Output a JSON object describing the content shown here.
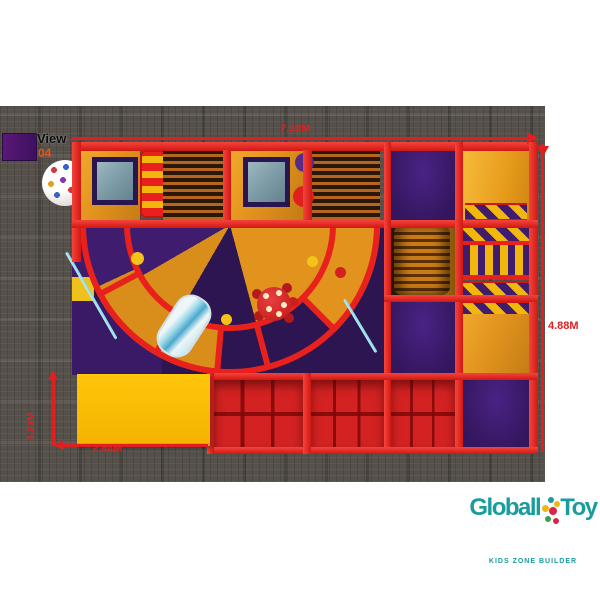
{
  "view": {
    "title": "View",
    "number": "04"
  },
  "dimensions": {
    "overall_width": "7.32M",
    "overall_depth": "4.88M",
    "mat_length": "2.44M",
    "mat_width": "1.22M"
  },
  "logo": {
    "brand_left": "Globall",
    "brand_right": "Toy",
    "tagline": "KIDS ZONE BUILDER"
  },
  "colors": {
    "frame_red": "#e8211d",
    "panel_orange": "#e2931e",
    "panel_purple": "#3f1c6e",
    "panel_navy": "#2c1550",
    "mat_yellow": "#ffc60a",
    "hazard_yellow": "#f2b70d",
    "pit_red": "#d42222",
    "carpet_gray": "#55504a",
    "dimension_red": "#e02020",
    "logo_teal": "#189c9c",
    "view_number_orange": "#e2561c"
  }
}
